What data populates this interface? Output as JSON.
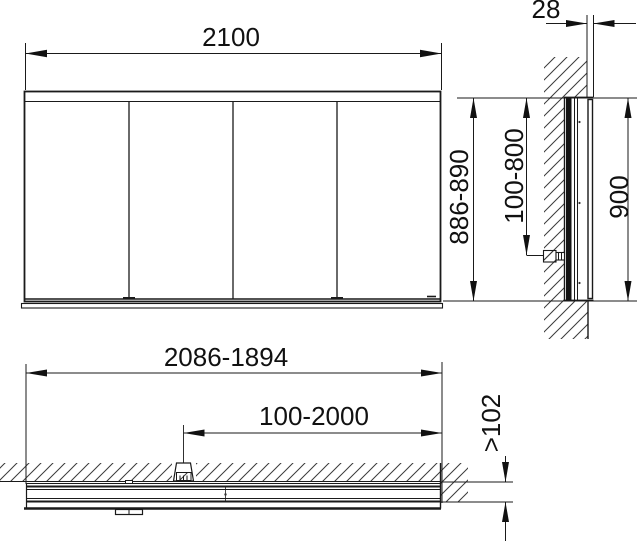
{
  "page": {
    "title": "Mirror cabinet dimensional drawing"
  },
  "colors": {
    "line": "#1a1a1a",
    "hatch": "#3a3a3a",
    "background": "#ffffff"
  },
  "front_view": {
    "width_dim": "2100"
  },
  "side_view": {
    "protrusion_dim": "28",
    "height_dim": "886-890",
    "connection_range_dim": "100-800",
    "niche_height_dim": "900"
  },
  "plan_view": {
    "niche_width_dim": "2086-1894",
    "connection_position_dim": "100-2000",
    "niche_depth_dim": ">102"
  }
}
